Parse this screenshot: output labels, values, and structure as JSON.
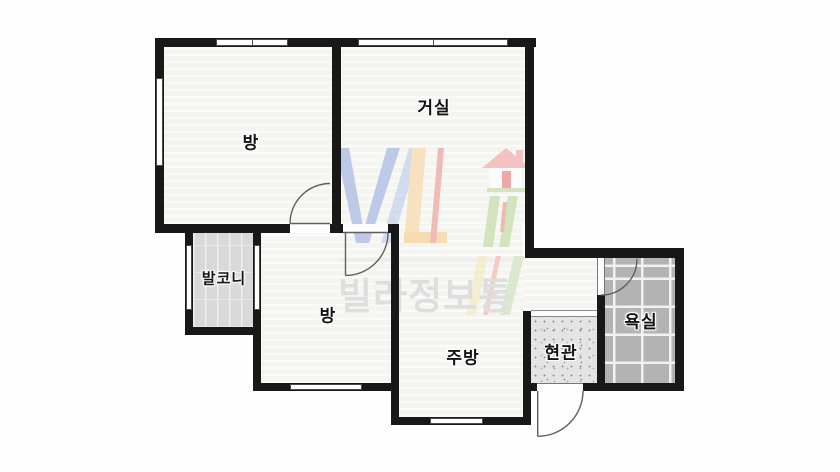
{
  "floorplan": {
    "rooms": [
      {
        "id": "room-top-left",
        "label": "방"
      },
      {
        "id": "living-room",
        "label": "거실"
      },
      {
        "id": "balcony",
        "label": "발코니"
      },
      {
        "id": "room-middle",
        "label": "방"
      },
      {
        "id": "kitchen",
        "label": "주방"
      },
      {
        "id": "entrance",
        "label": "현관"
      },
      {
        "id": "bathroom",
        "label": "욕실"
      }
    ],
    "watermark": {
      "brand_text": "빌라정보통",
      "logo_letters": "VL",
      "logo_icon": "house-icon"
    },
    "colors": {
      "wall": "#181818",
      "room_fill": "#f6f6f3",
      "balcony_fill": "#d9d9d9",
      "bathroom_tile": "#b3b3b3",
      "bathroom_grout": "#f2f2f2",
      "entrance_fill": "#e4e4e4",
      "door_arc": "#5f5f5f",
      "watermark_text": "#dedede",
      "logo_blue": "#b6c5e6",
      "logo_peach": "#f8dfba",
      "logo_red": "#f0b5b0",
      "logo_green": "#cfe2b8"
    }
  }
}
